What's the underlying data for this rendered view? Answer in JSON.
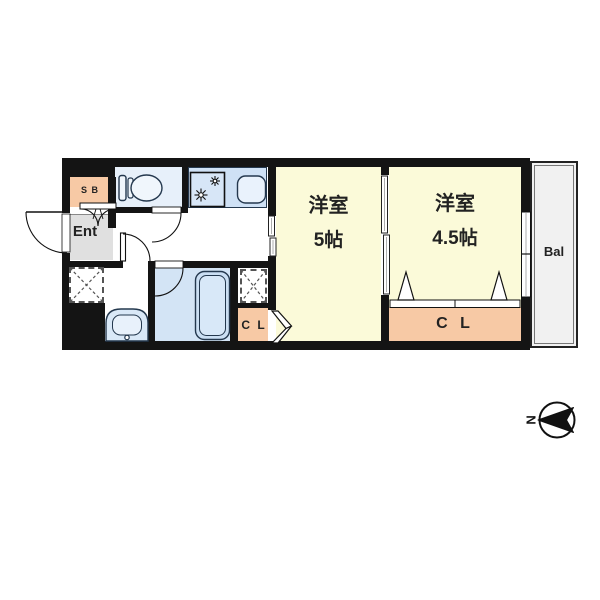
{
  "floorplan": {
    "entrance": {
      "label": "Ent",
      "shoe_box_label": "S B"
    },
    "rooms": [
      {
        "name": "洋室",
        "size": "5帖"
      },
      {
        "name": "洋室",
        "size": "4.5帖"
      }
    ],
    "closets": {
      "small_label": "C L",
      "large_label": "C L"
    },
    "balcony_label": "Bal",
    "compass": {
      "north_label": "N"
    },
    "colors": {
      "wall": "#141414",
      "room_cream": "#FBFAD9",
      "closet_peach": "#F7C9A5",
      "wet_area_blue": "#D3E4F5",
      "fixture_blue": "#CFE1F5",
      "entrance_gray": "#E0E0E0",
      "balcony_gray": "#F1F1F1"
    }
  }
}
